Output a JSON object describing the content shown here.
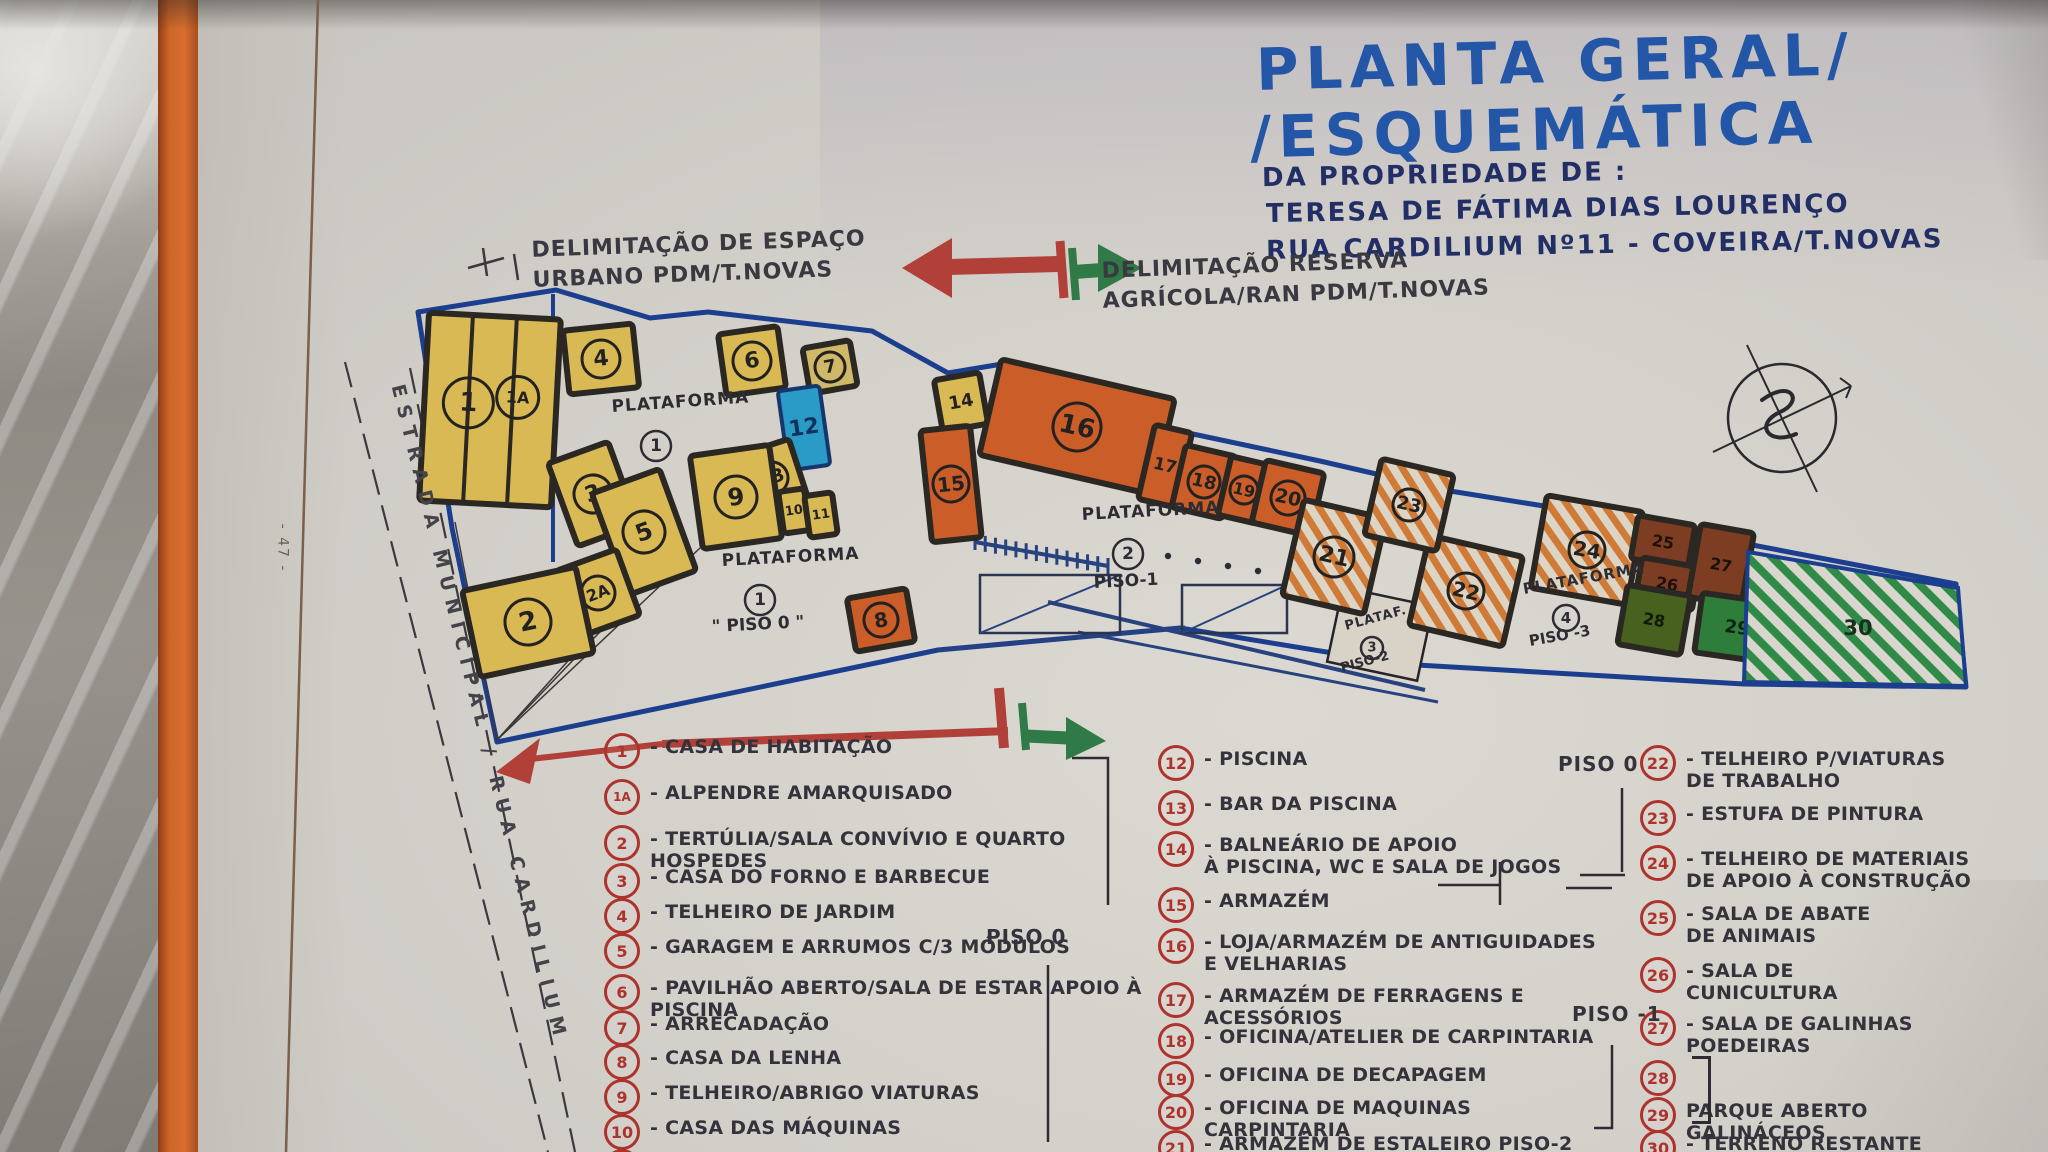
{
  "page_number": "- 47 -",
  "title": {
    "line1": "PLANTA GERAL/",
    "line2": "/ESQUEMÁTICA",
    "line3": "DA PROPRIEDADE DE :",
    "line4": "TERESA DE FÁTIMA DIAS LOURENÇO",
    "line5": "RUA CARDILIUM Nº11 - COVEIRA/T.NOVAS"
  },
  "annotations": {
    "urban": {
      "l1": "DELIMITAÇÃO DE ESPAÇO",
      "l2": "URBANO  PDM/T.NOVAS"
    },
    "agri": {
      "l1": "DELIMITAÇÃO RESERVA",
      "l2": "AGRÍCOLA/RAN  PDM/T.NOVAS"
    },
    "road": "ESTRADA MUNICIPAL / RUA CARDILIUM"
  },
  "map": {
    "platforms": [
      {
        "name": "PLATAFORMA",
        "num": "1",
        "piso": ""
      },
      {
        "name": "PLATAFORMA",
        "num": "1",
        "piso": "\" PISO 0 \""
      },
      {
        "name": "PLATAFORMA",
        "num": "2",
        "piso": "PISO-1"
      },
      {
        "name": "PLATAF.",
        "num": "3",
        "piso": "PISO-2"
      },
      {
        "name": "PLATAFORMA",
        "num": "4",
        "piso": "PISO -3"
      }
    ],
    "building_labels": [
      "1",
      "1A",
      "4",
      "6",
      "7",
      "12",
      "13",
      "9",
      "10",
      "11",
      "3",
      "5",
      "2A",
      "2",
      "8",
      "14",
      "15",
      "16",
      "17",
      "18",
      "19",
      "20",
      "21",
      "22",
      "23",
      "24",
      "25",
      "26",
      "27",
      "28",
      "29",
      "30"
    ]
  },
  "legend": {
    "piso": {
      "col2": "PISO 0",
      "col3_top": "PISO 0",
      "col3_mid": "PISO -1"
    },
    "columns": [
      {
        "items": [
          {
            "num": "1",
            "label": "- CASA DE HABITAÇÃO"
          },
          {
            "num": "1A",
            "label": "- ALPENDRE AMARQUISADO"
          },
          {
            "num": "2",
            "label": "- TERTÚLIA/SALA CONVÍVIO E QUARTO HOSPEDES"
          },
          {
            "num": "3",
            "label": "- CASA DO FORNO E BARBECUE"
          },
          {
            "num": "4",
            "label": "- TELHEIRO DE JARDIM"
          },
          {
            "num": "5",
            "label": "- GARAGEM E ARRUMOS C/3 MÓDULOS"
          },
          {
            "num": "6",
            "label": "- PAVILHÃO ABERTO/SALA DE ESTAR APOIO À PISCINA"
          },
          {
            "num": "7",
            "label": "- ARRECADAÇÃO"
          },
          {
            "num": "8",
            "label": "- CASA DA LENHA"
          },
          {
            "num": "9",
            "label": "- TELHEIRO/ABRIGO VIATURAS"
          },
          {
            "num": "10",
            "label": "- CASA DAS MÁQUINAS"
          },
          {
            "num": "11",
            "label": ""
          }
        ]
      },
      {
        "items": [
          {
            "num": "12",
            "label": "- PISCINA"
          },
          {
            "num": "13",
            "label": "- BAR DA PISCINA"
          },
          {
            "num": "14",
            "label": "- BALNEÁRIO DE APOIO\nÀ PISCINA, WC E SALA DE JOGOS"
          },
          {
            "num": "15",
            "label": "- ARMAZÉM"
          },
          {
            "num": "16",
            "label": "- LOJA/ARMAZÉM DE ANTIGUIDADES\nE VELHARIAS"
          },
          {
            "num": "17",
            "label": "- ARMAZÉM DE FERRAGENS E ACESSÓRIOS"
          },
          {
            "num": "18",
            "label": "- OFICINA/ATELIER DE CARPINTARIA"
          },
          {
            "num": "19",
            "label": "- OFICINA DE DECAPAGEM"
          },
          {
            "num": "20",
            "label": "- OFICINA DE MAQUINAS CARPINTARIA"
          },
          {
            "num": "21",
            "label": "- ARMAZÉM DE ESTALEIRO PISO-2"
          }
        ]
      },
      {
        "items": [
          {
            "num": "22",
            "label": "- TELHEIRO P/VIATURAS\nDE TRABALHO"
          },
          {
            "num": "23",
            "label": "- ESTUFA DE PINTURA"
          },
          {
            "num": "24",
            "label": "- TELHEIRO DE MATERIAIS\nDE APOIO À CONSTRUÇÃO"
          },
          {
            "num": "25",
            "label": "- SALA DE ABATE\nDE ANIMAIS"
          },
          {
            "num": "26",
            "label": "- SALA DE\nCUNICULTURA"
          },
          {
            "num": "27",
            "label": "- SALA DE GALINHAS\nPOEDEIRAS"
          },
          {
            "num": "28",
            "label": ""
          },
          {
            "num": "29",
            "label": "PARQUE ABERTO\nGALINÁCEOS"
          },
          {
            "num": "30",
            "label": "- TERRENO RESTANTE"
          }
        ]
      }
    ]
  },
  "colors": {
    "title_blue": "#2356a6",
    "ink": "#34323a",
    "legend_red": "#ad332c",
    "boundary_blue": "#1c3e8e",
    "yellow": "#d9b954",
    "orange": "#cb5e28",
    "pool_blue": "#2a9bc7",
    "brown": "#7c3d22",
    "green_dark": "#47611f",
    "green": "#2e7d3a",
    "hatch_green": "#2f8b47",
    "hatch_orange": "#cf7a36",
    "arrow_red": "#b04038",
    "arrow_green": "#2f7a46",
    "folder_orange": "#cd6527"
  }
}
